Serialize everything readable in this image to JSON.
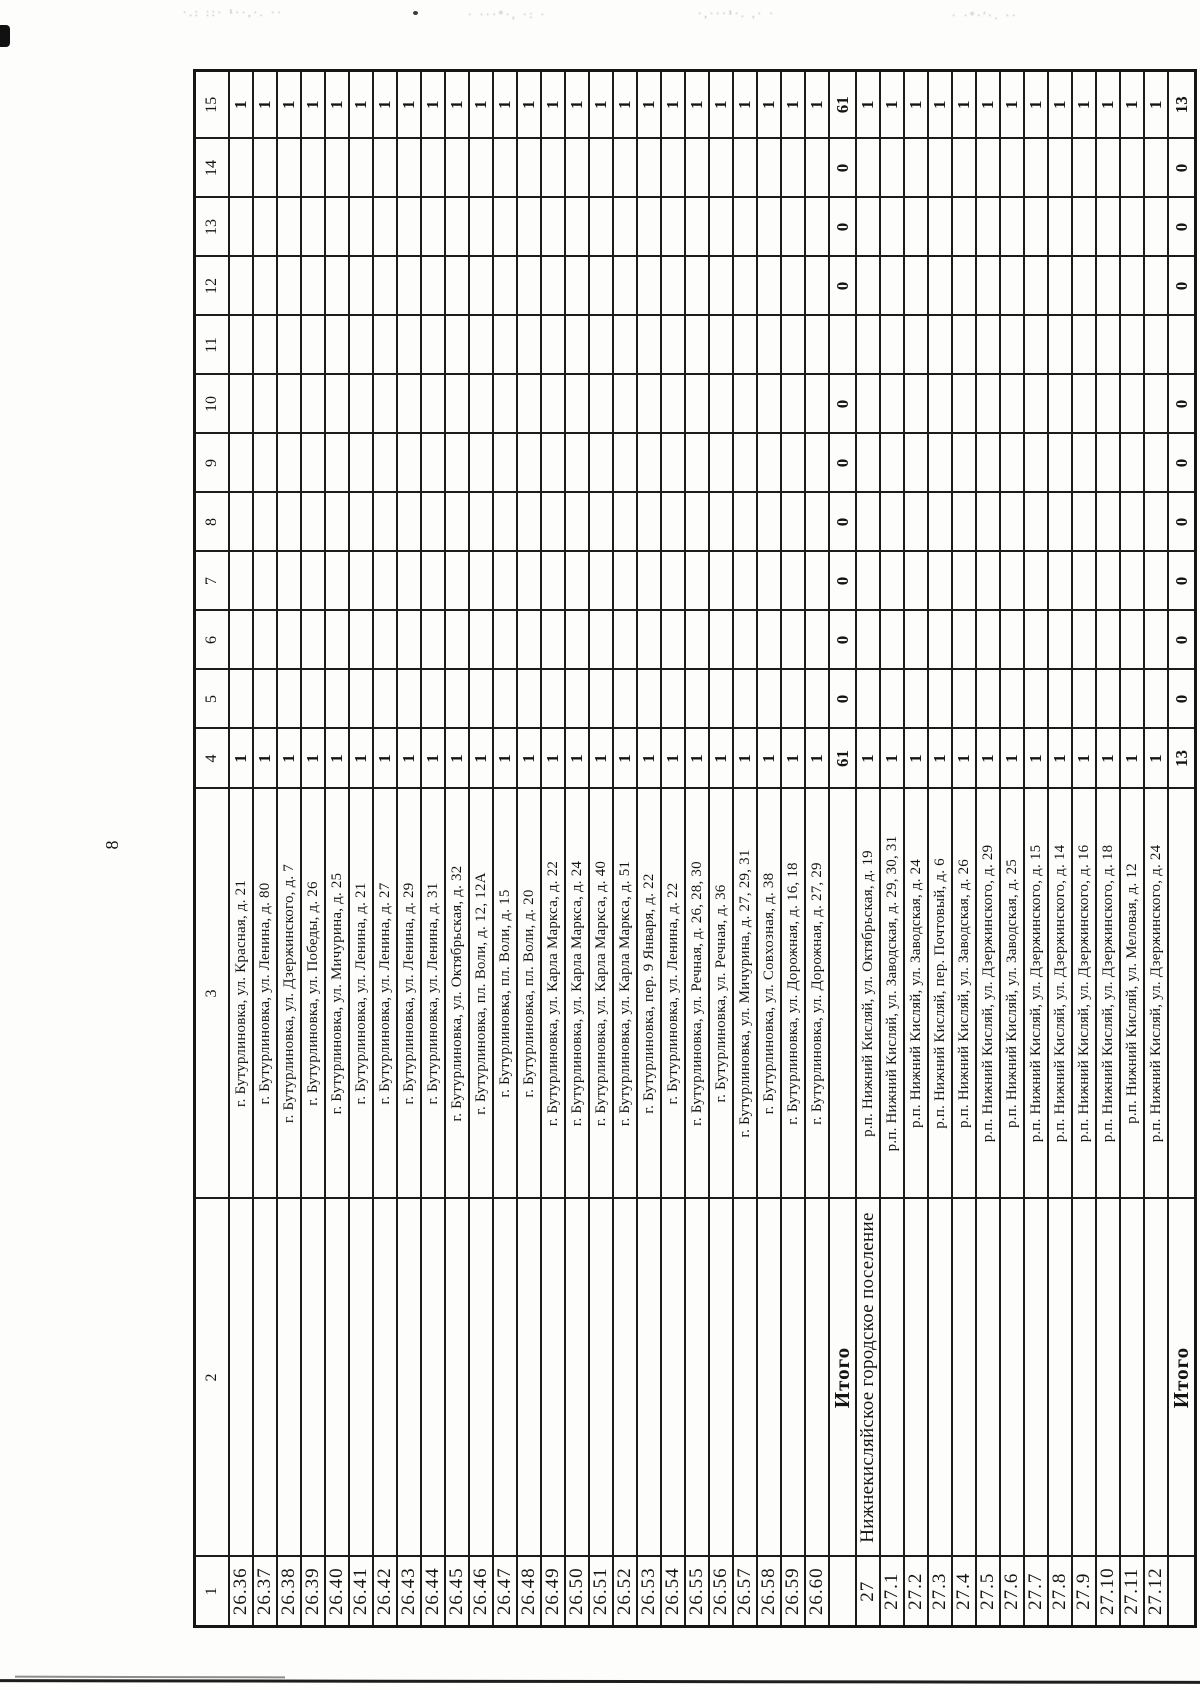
{
  "page": {
    "number": "8"
  },
  "scan_artifacts": {
    "noise1": "·.: ::· ¹··,·. ··",
    "noise2": "· ···°·, ·: ·",
    "noise3": "·,···¹·. ,· ·",
    "noise4": "· ·°·'·.  ··"
  },
  "table": {
    "header_cells": [
      "1",
      "2",
      "3",
      "4",
      "5",
      "6",
      "7",
      "8",
      "9",
      "10",
      "11",
      "12",
      "13",
      "14",
      "15"
    ],
    "rows": [
      {
        "type": "data",
        "id": "26.36",
        "settlement": "",
        "address": "г. Бутурлиновка,  ул. Красная, д. 21",
        "values": {
          "4": "1",
          "15": "1"
        }
      },
      {
        "type": "data",
        "id": "26.37",
        "settlement": "",
        "address": "г. Бутурлиновка, ул. Ленина, д. 80",
        "values": {
          "4": "1",
          "15": "1"
        }
      },
      {
        "type": "data",
        "id": "26.38",
        "settlement": "",
        "address": "г. Бутурлиновка, ул. Дзержинского, д. 7",
        "values": {
          "4": "1",
          "15": "1"
        }
      },
      {
        "type": "data",
        "id": "26.39",
        "settlement": "",
        "address": "г. Бутурлиновка, ул. Победы, д. 26",
        "values": {
          "4": "1",
          "15": "1"
        }
      },
      {
        "type": "data",
        "id": "26.40",
        "settlement": "",
        "address": "г. Бутурлиновка, ул. Мичурина, д. 25",
        "values": {
          "4": "1",
          "15": "1"
        }
      },
      {
        "type": "data",
        "id": "26.41",
        "settlement": "",
        "address": "г. Бутурлиновка, ул. Ленина, д. 21",
        "values": {
          "4": "1",
          "15": "1"
        }
      },
      {
        "type": "data",
        "id": "26.42",
        "settlement": "",
        "address": "г. Бутурлиновка, ул. Ленина, д. 27",
        "values": {
          "4": "1",
          "15": "1"
        }
      },
      {
        "type": "data",
        "id": "26.43",
        "settlement": "",
        "address": "г. Бутурлиновка, ул. Ленина, д. 29",
        "values": {
          "4": "1",
          "15": "1"
        }
      },
      {
        "type": "data",
        "id": "26.44",
        "settlement": "",
        "address": "г. Бутурлиновка, ул. Ленина, д. 31",
        "values": {
          "4": "1",
          "15": "1"
        }
      },
      {
        "type": "data",
        "id": "26.45",
        "settlement": "",
        "address": "г. Бутурлиновка, ул. Октябрьская, д. 32",
        "values": {
          "4": "1",
          "15": "1"
        }
      },
      {
        "type": "data",
        "id": "26.46",
        "settlement": "",
        "address": "г. Бутурлиновка, пл. Воли, д. 12, 12А",
        "values": {
          "4": "1",
          "15": "1"
        }
      },
      {
        "type": "data",
        "id": "26.47",
        "settlement": "",
        "address": "г. Бутурлиновка, пл. Воли, д. 15",
        "values": {
          "4": "1",
          "15": "1"
        }
      },
      {
        "type": "data",
        "id": "26.48",
        "settlement": "",
        "address": "г. Бутурлиновка, пл. Воли, д. 20",
        "values": {
          "4": "1",
          "15": "1"
        }
      },
      {
        "type": "data",
        "id": "26.49",
        "settlement": "",
        "address": "г. Бутурлиновка, ул. Карла Маркса, д. 22",
        "values": {
          "4": "1",
          "15": "1"
        }
      },
      {
        "type": "data",
        "id": "26.50",
        "settlement": "",
        "address": "г. Бутурлиновка, ул. Карла Маркса, д. 24",
        "values": {
          "4": "1",
          "15": "1"
        }
      },
      {
        "type": "data",
        "id": "26.51",
        "settlement": "",
        "address": "г. Бутурлиновка, ул. Карла Маркса, д. 40",
        "values": {
          "4": "1",
          "15": "1"
        }
      },
      {
        "type": "data",
        "id": "26.52",
        "settlement": "",
        "address": "г. Бутурлиновка, ул. Карла Маркса, д. 51",
        "values": {
          "4": "1",
          "15": "1"
        }
      },
      {
        "type": "data",
        "id": "26.53",
        "settlement": "",
        "address": "г. Бутурлиновка, пер. 9 Января, д. 22",
        "values": {
          "4": "1",
          "15": "1"
        }
      },
      {
        "type": "data",
        "id": "26.54",
        "settlement": "",
        "address": "г. Бутурлиновка, ул. Ленина, д. 22",
        "values": {
          "4": "1",
          "15": "1"
        }
      },
      {
        "type": "data",
        "id": "26.55",
        "settlement": "",
        "address": "г. Бутурлиновка, ул. Речная, д. 26, 28, 30",
        "values": {
          "4": "1",
          "15": "1"
        }
      },
      {
        "type": "data",
        "id": "26.56",
        "settlement": "",
        "address": "г. Бутурлиновка, ул. Речная, д. 36",
        "values": {
          "4": "1",
          "15": "1"
        }
      },
      {
        "type": "data",
        "id": "26.57",
        "settlement": "",
        "address": "г. Бутурлиновка, ул. Мичурина, д. 27, 29, 31",
        "values": {
          "4": "1",
          "15": "1"
        }
      },
      {
        "type": "data",
        "id": "26.58",
        "settlement": "",
        "address": "г. Бутурлиновка, ул. Совхозная, д. 38",
        "values": {
          "4": "1",
          "15": "1"
        }
      },
      {
        "type": "data",
        "id": "26.59",
        "settlement": "",
        "address": "г. Бутурлиновка,  ул. Дорожная, д. 16, 18",
        "values": {
          "4": "1",
          "15": "1"
        }
      },
      {
        "type": "data",
        "id": "26.60",
        "settlement": "",
        "address": "г. Бутурлиновка, ул. Дорожная, д. 27, 29",
        "values": {
          "4": "1",
          "15": "1"
        }
      },
      {
        "type": "total",
        "label": "Итого",
        "values": {
          "4": "61",
          "5": "0",
          "6": "0",
          "7": "0",
          "8": "0",
          "9": "0",
          "10": "0",
          "12": "0",
          "13": "0",
          "14": "0",
          "15": "61"
        }
      },
      {
        "type": "data",
        "id": "27",
        "settlement": "Нижнекисляйское городское поселение",
        "address": "р.п. Нижний Кисляй, ул. Октябрьская, д. 19",
        "values": {
          "4": "1",
          "15": "1"
        }
      },
      {
        "type": "data",
        "id": "27.1",
        "settlement": "",
        "address": "р.п. Нижний Кисляй, ул. Заводская, д. 29, 30, 31",
        "values": {
          "4": "1",
          "15": "1"
        }
      },
      {
        "type": "data",
        "id": "27.2",
        "settlement": "",
        "address": "р.п. Нижний Кисляй, ул. Заводская, д. 24",
        "values": {
          "4": "1",
          "15": "1"
        }
      },
      {
        "type": "data",
        "id": "27.3",
        "settlement": "",
        "address": "р.п. Нижний Кисляй, пер. Почтовый, д. 6",
        "values": {
          "4": "1",
          "15": "1"
        }
      },
      {
        "type": "data",
        "id": "27.4",
        "settlement": "",
        "address": "р.п. Нижний Кисляй, ул. Заводская, д. 26",
        "values": {
          "4": "1",
          "15": "1"
        }
      },
      {
        "type": "data",
        "id": "27.5",
        "settlement": "",
        "address": "р.п. Нижний Кисляй, ул. Дзержинского, д. 29",
        "values": {
          "4": "1",
          "15": "1"
        }
      },
      {
        "type": "data",
        "id": "27.6",
        "settlement": "",
        "address": "р.п. Нижний Кисляй, ул. Заводская, д. 25",
        "values": {
          "4": "1",
          "15": "1"
        }
      },
      {
        "type": "data",
        "id": "27.7",
        "settlement": "",
        "address": "р.п. Нижний Кисляй,  ул. Дзержинского, д. 15",
        "values": {
          "4": "1",
          "15": "1"
        }
      },
      {
        "type": "data",
        "id": "27.8",
        "settlement": "",
        "address": "р.п. Нижний Кисляй,  ул. Дзержинского, д. 14",
        "values": {
          "4": "1",
          "15": "1"
        }
      },
      {
        "type": "data",
        "id": "27.9",
        "settlement": "",
        "address": "р.п. Нижний Кисляй, ул. Дзержинского, д. 16",
        "values": {
          "4": "1",
          "15": "1"
        }
      },
      {
        "type": "data",
        "id": "27.10",
        "settlement": "",
        "address": "р.п. Нижний Кисляй,  ул. Дзержинского, д. 18",
        "values": {
          "4": "1",
          "15": "1"
        }
      },
      {
        "type": "data",
        "id": "27.11",
        "settlement": "",
        "address": "р.п. Нижний Кисляй, ул. Меловая, д. 12",
        "values": {
          "4": "1",
          "15": "1"
        }
      },
      {
        "type": "data",
        "id": "27.12",
        "settlement": "",
        "address": "р.п. Нижний Кисляй, ул. Дзержинского, д. 24",
        "values": {
          "4": "1",
          "15": "1"
        }
      },
      {
        "type": "total",
        "label": "Итого",
        "values": {
          "4": "13",
          "5": "0",
          "6": "0",
          "7": "0",
          "8": "0",
          "9": "0",
          "10": "0",
          "12": "0",
          "13": "0",
          "14": "0",
          "15": "13"
        }
      }
    ]
  }
}
